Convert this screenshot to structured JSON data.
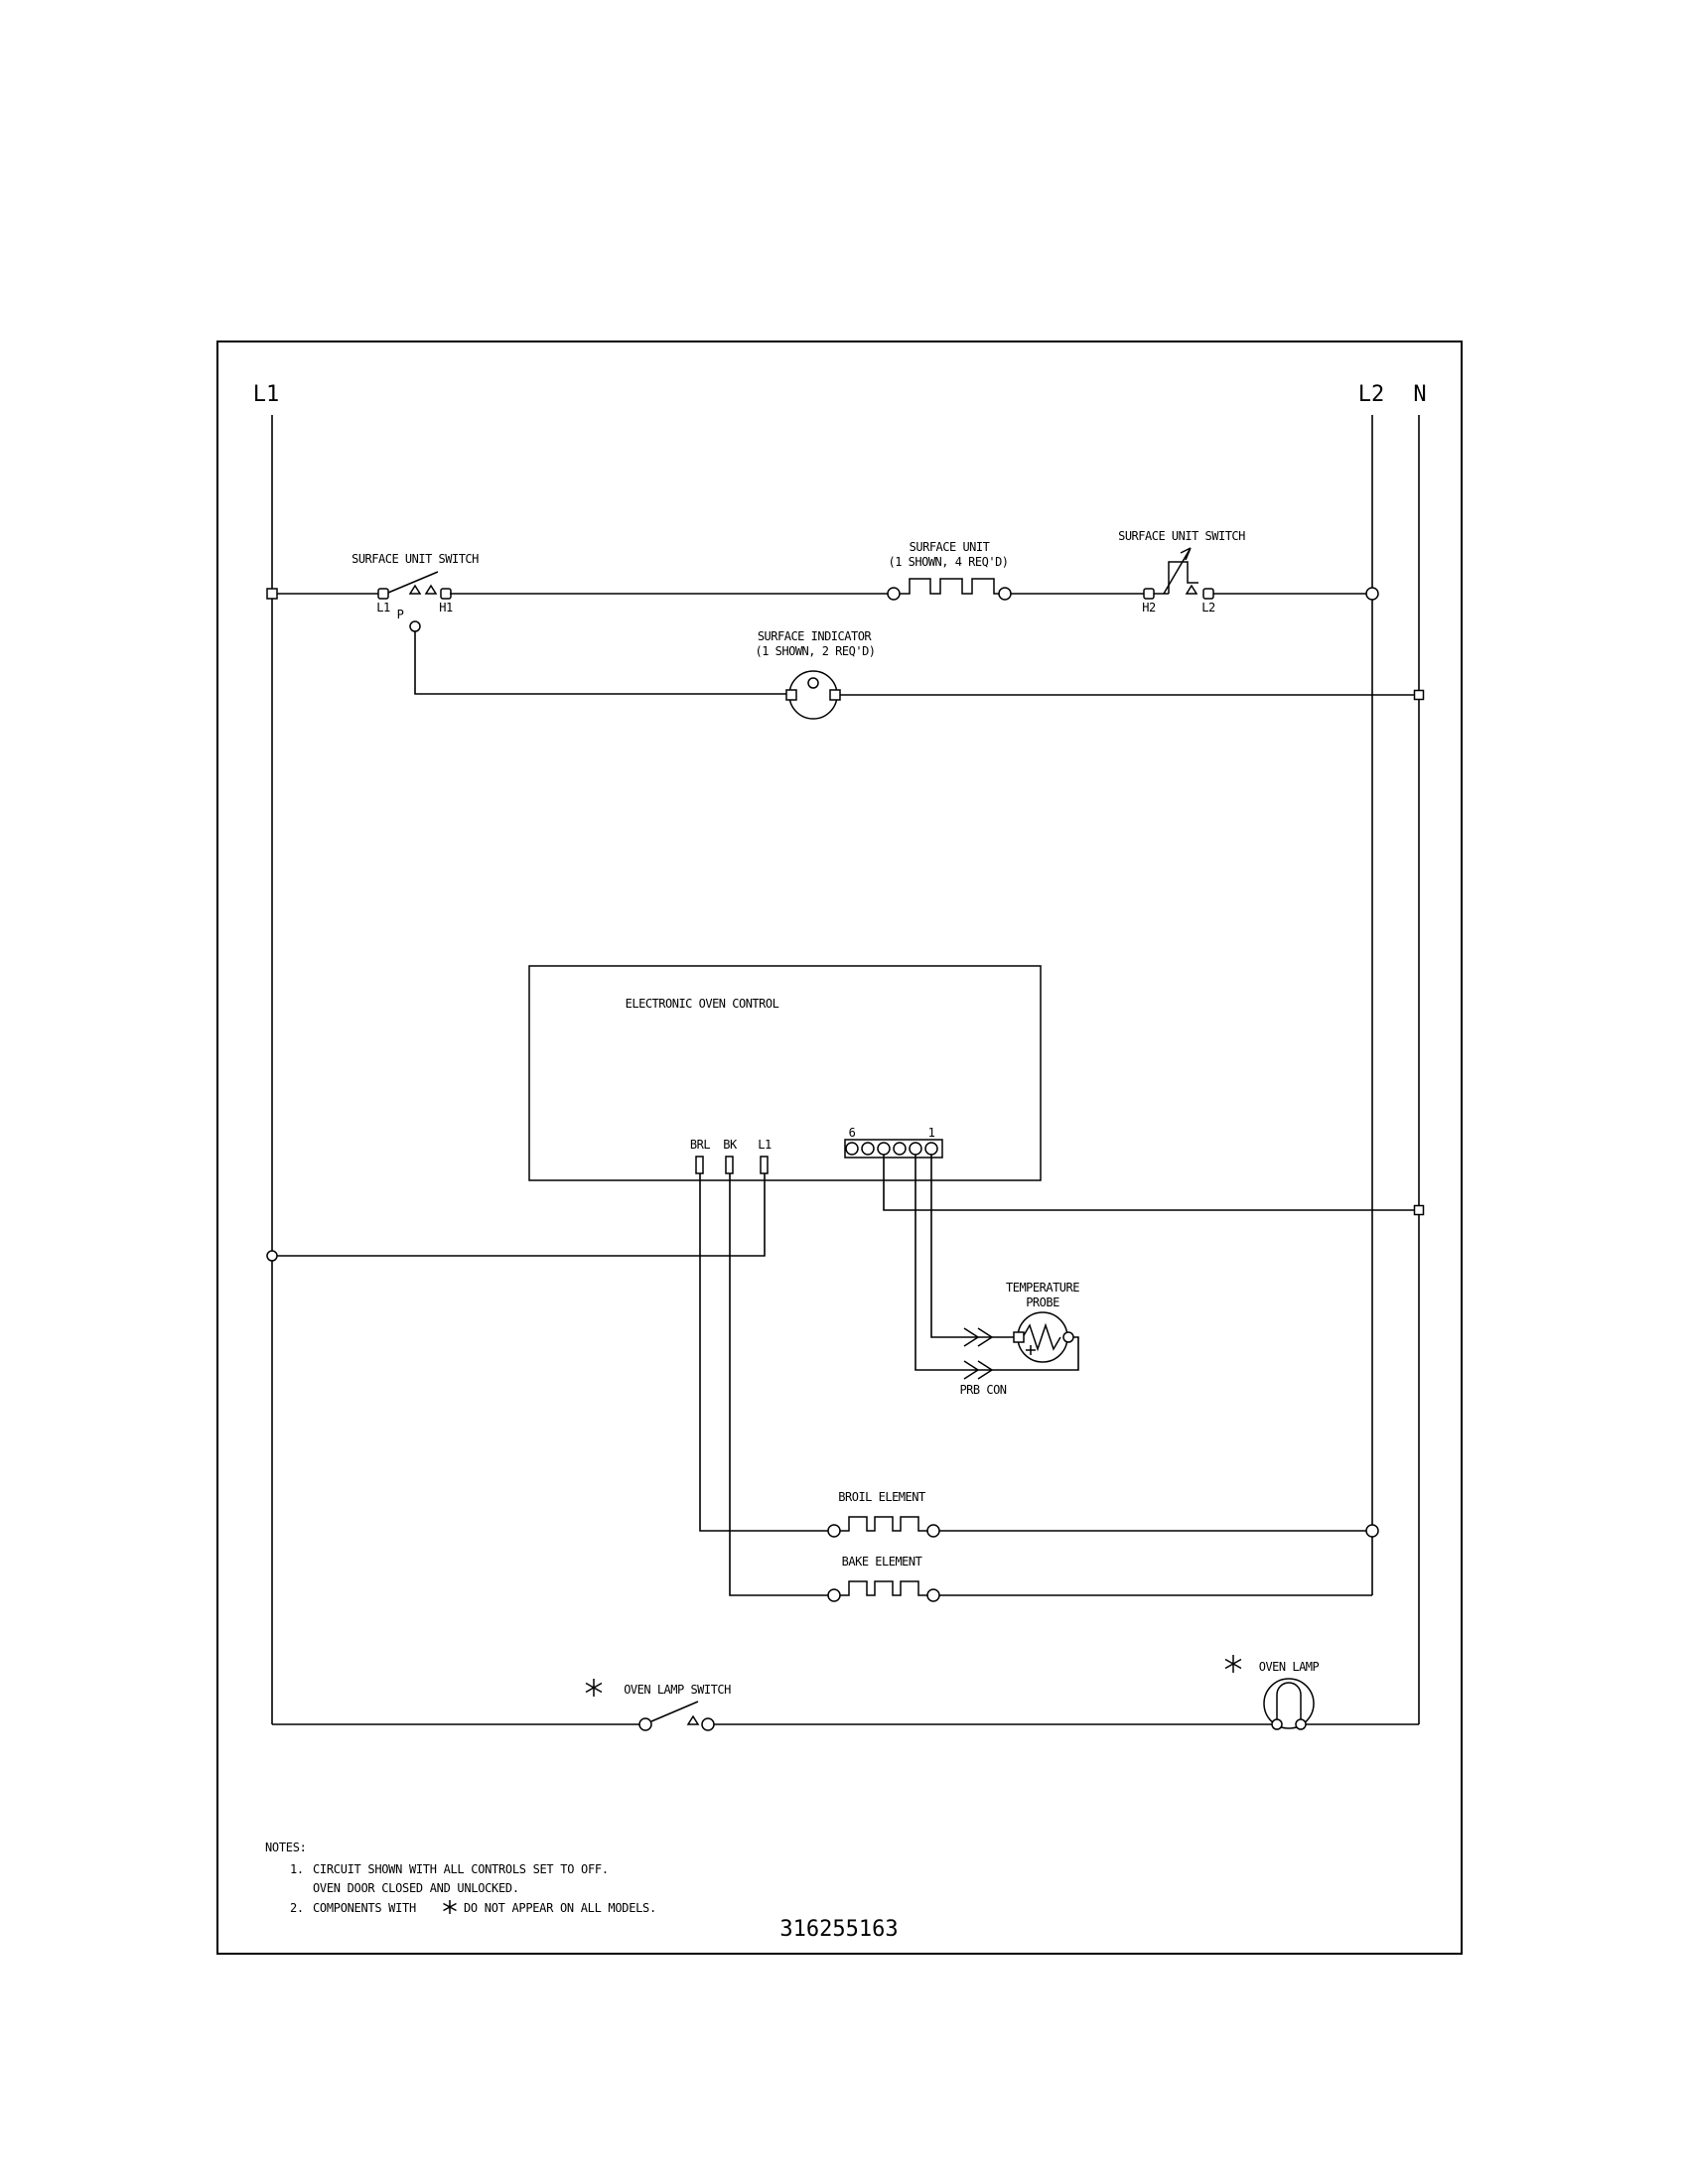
{
  "colors": {
    "ink": "#000000",
    "paper": "#ffffff"
  },
  "rails": {
    "l1": "L1",
    "l2": "L2",
    "n": "N"
  },
  "top_row": {
    "left_switch": {
      "label": "SURFACE UNIT SWITCH",
      "t_l1": "L1",
      "t_p": "P",
      "t_h1": "H1"
    },
    "surface_unit": {
      "name": "SURFACE UNIT",
      "qty": "(1 SHOWN, 4 REQ'D)"
    },
    "right_switch": {
      "label": "SURFACE UNIT SWITCH",
      "t_h2": "H2",
      "t_l2": "L2"
    }
  },
  "indicator": {
    "name": "SURFACE INDICATOR",
    "qty": "(1 SHOWN, 2 REQ'D)"
  },
  "eoc": {
    "title": "ELECTRONIC OVEN CONTROL",
    "pin_brl": "BRL",
    "pin_bk": "BK",
    "pin_l1": "L1",
    "conn_6": "6",
    "conn_1": "1"
  },
  "probe": {
    "line1": "TEMPERATURE",
    "line2": "PROBE",
    "conn": "PRB CON"
  },
  "elements": {
    "broil": "BROIL ELEMENT",
    "bake": "BAKE ELEMENT"
  },
  "lamp": {
    "switch_label": "OVEN LAMP SWITCH",
    "lamp_label": "OVEN LAMP"
  },
  "notes": {
    "heading": "NOTES:",
    "n1": "1.",
    "n1_line1": "CIRCUIT SHOWN WITH ALL CONTROLS SET TO OFF.",
    "n1_line2": "OVEN DOOR CLOSED AND UNLOCKED.",
    "n2": "2.",
    "n2_pre": "COMPONENTS WITH",
    "n2_post": "DO NOT APPEAR ON ALL MODELS."
  },
  "part_number": "316255163"
}
